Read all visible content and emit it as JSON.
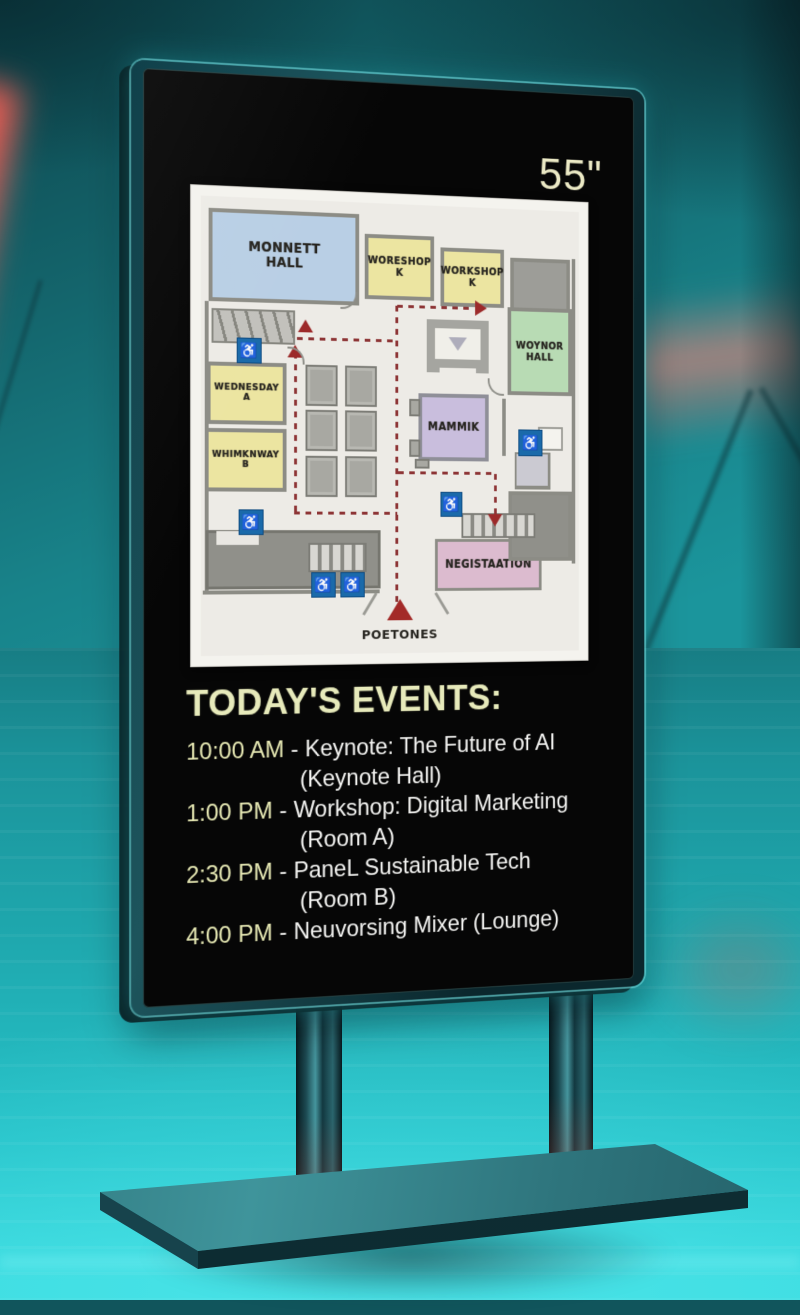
{
  "kiosk": {
    "size_label": "55\"",
    "accent_color": "#e7eabb",
    "screen_color": "#060606"
  },
  "map": {
    "rooms": {
      "keynote_hall": {
        "label": "MONNETT\nHALL",
        "color": "#b9cfe5"
      },
      "workshop_1": {
        "label": "WORESHOP\nK",
        "color": "#ece5a1"
      },
      "workshop_2": {
        "label": "WORKSHOP\nK",
        "color": "#ece5a1"
      },
      "right_hall": {
        "label": "WOYNOR\nHALL",
        "color": "#b8dbb4"
      },
      "center_room": {
        "label": "MAMMIK",
        "color": "#c9bedd"
      },
      "room_a": {
        "label": "WEDNESDAY\nA",
        "color": "#ece5a1"
      },
      "room_b": {
        "label": "WHIMKNWAY\nB",
        "color": "#ece5a1"
      },
      "registration": {
        "label": "NEGISTAATION",
        "color": "#dcbbcf"
      }
    },
    "entrance_label": "POETONES",
    "icons": {
      "accessibility": "♿"
    },
    "route_color": "#8d3435"
  },
  "events": {
    "title": "TODAY'S EVENTS:",
    "items": [
      {
        "time": "10:00 AM",
        "separator": "-",
        "title": "Keynote: The Future of AI",
        "location": "(Keynote Hall)"
      },
      {
        "time": "1:00 PM",
        "separator": "-",
        "title": "Workshop: Digital Marketing",
        "location": "(Room A)"
      },
      {
        "time": "2:30 PM",
        "separator": "-",
        "title": "PaneL Sustainable Tech",
        "location": "(Room B)"
      },
      {
        "time": "4:00 PM",
        "separator": "-",
        "title": "Neuvorsing Mixer (Lounge)",
        "location": ""
      }
    ]
  }
}
